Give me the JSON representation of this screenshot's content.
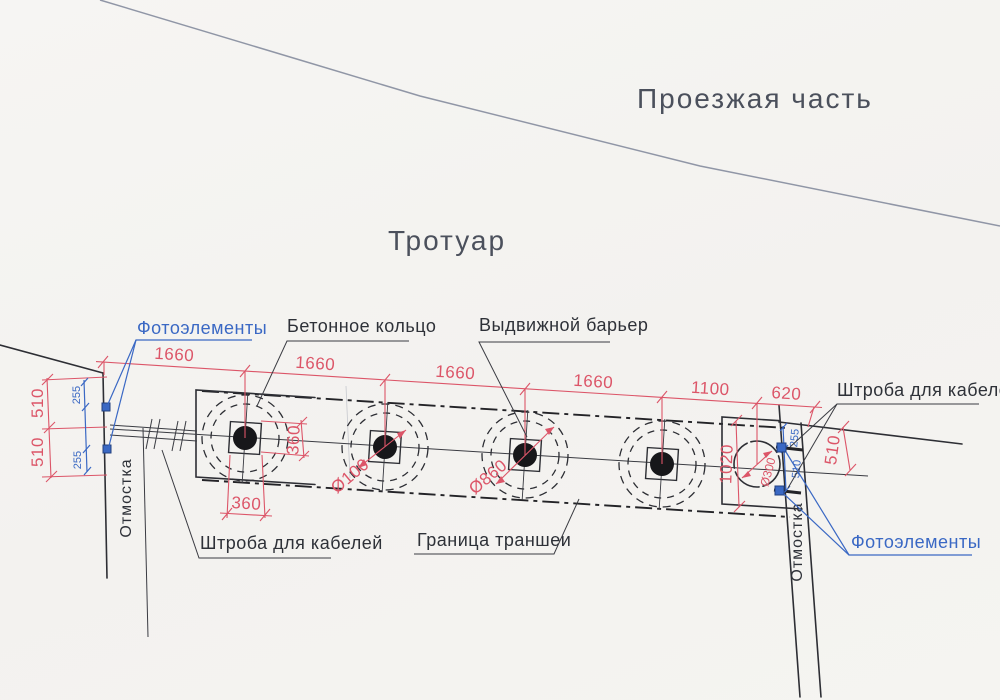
{
  "areas": {
    "roadway": "Проезжая часть",
    "sidewalk": "Тротуар"
  },
  "callouts": {
    "photocells": "Фотоэлементы",
    "concrete_ring": "Бетонное кольцо",
    "retractable_barrier": "Выдвижной барьер",
    "cable_chase": "Штроба для кабелей",
    "trench_boundary": "Граница траншеи",
    "blind_area": "Отмостка"
  },
  "dimensions": {
    "chain": [
      "1660",
      "1660",
      "1660",
      "1660",
      "1100",
      "620"
    ],
    "left_red": [
      "510",
      "510"
    ],
    "left_blue": [
      "255",
      "255"
    ],
    "right_red": "510",
    "right_blue_top": "255",
    "right_blue_mid": "510",
    "trench_width": "1020",
    "square_w": "360",
    "square_h": "360",
    "dia_bollard": "Ø100",
    "dia_ring": "Ø860",
    "dia_well": "Ø300"
  },
  "colors": {
    "dimension_red": "#dc5568",
    "annotation_blue": "#3a68c4",
    "drawing_black": "#2d2e34",
    "road_gray": "#9096a6",
    "paper": "#f5f4f1"
  }
}
